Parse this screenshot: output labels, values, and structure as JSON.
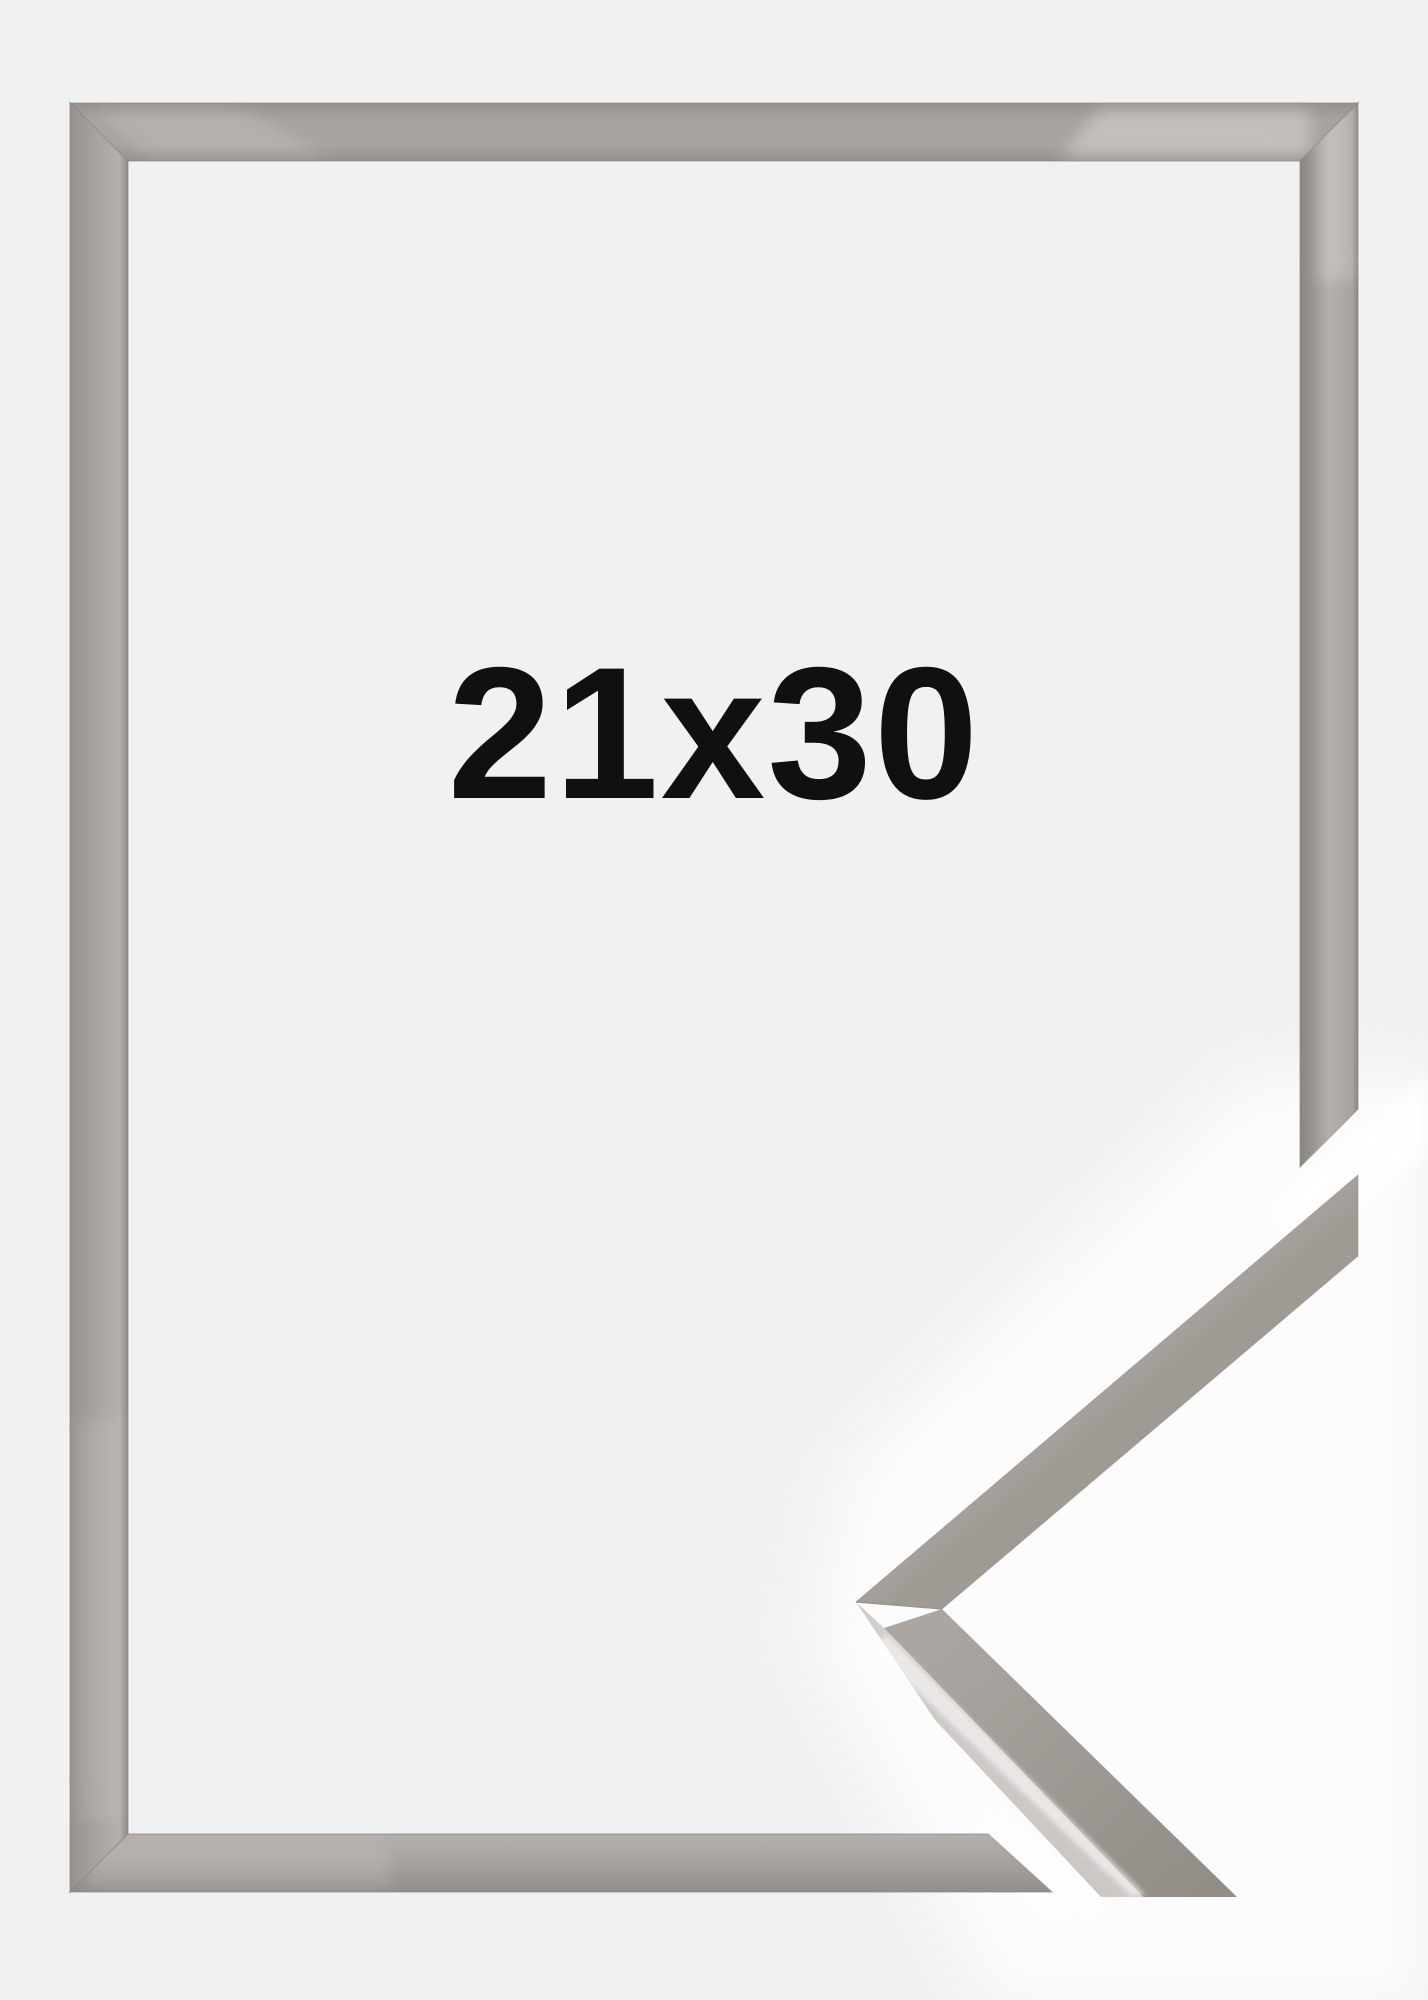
{
  "page": {
    "background_color": "#f1f1f2",
    "sample_area_color": "#ffffff"
  },
  "frame_preview": {
    "size_label": "21x30",
    "label_color": "#101010",
    "frame": {
      "base_color": "#a8a39f",
      "edge_color": "#8a8682",
      "face_light": "#b4b0ad",
      "face_dark": "#96918d",
      "sheen_color": "#ffffff"
    },
    "corner_sample": {
      "band_light": "#b6b2af",
      "band_base": "#a8a29e",
      "band_dark": "#a09a95",
      "top_face_light": "#aca6a2",
      "top_face_dark": "#938d88",
      "side_face_light": "#d4d1cf",
      "side_face_dark": "#c3c0be",
      "ridge_highlight": "#ffffff",
      "seam_color": "#98928e"
    }
  }
}
